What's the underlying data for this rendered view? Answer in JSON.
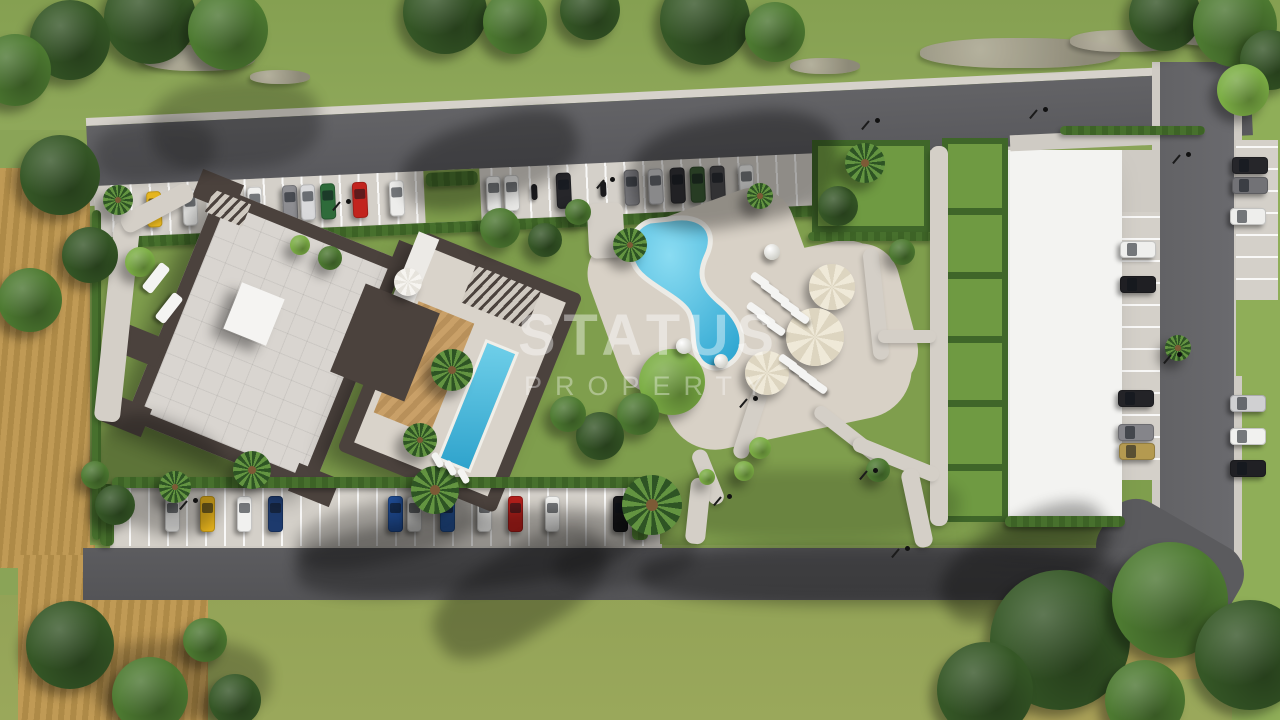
{
  "watermark": {
    "line1": "STATUS",
    "line2": "PROPERTY"
  },
  "palette": {
    "grassTop": "#8aa457",
    "grassBottom": "#9aa85b",
    "garden": "#7f9e4d",
    "field": "#bb9551",
    "road": "#5d5d60",
    "roadDark": "#55555a",
    "walk": "#d4cfc7",
    "apron": "#d4d0c9",
    "hedge": "#47702d",
    "wall": "#4b423d",
    "roof": "#d9d5d0",
    "deck": "#d8d1c6",
    "lawn": "#6f9a42",
    "wood": "#c49b63",
    "poolBlue": "#2ea6d1",
    "poolLight": "#8adcf2",
    "whiteRoof": "#f3f3f1",
    "umbrella": "#efe9d8"
  },
  "scene": {
    "shadows": [
      {
        "x": 400,
        "y": 120,
        "w": 180,
        "h": 80,
        "rot": -18,
        "op": 0.3
      },
      {
        "x": 630,
        "y": 115,
        "w": 210,
        "h": 110,
        "rot": -10,
        "op": 0.32
      },
      {
        "x": 150,
        "y": 80,
        "w": 170,
        "h": 90,
        "rot": -5,
        "op": 0.22
      },
      {
        "x": 95,
        "y": 120,
        "w": 120,
        "h": 60,
        "rot": -5,
        "op": 0.2
      },
      {
        "x": 88,
        "y": 420,
        "w": 140,
        "h": 110,
        "rot": 22,
        "op": 0.26
      },
      {
        "x": 295,
        "y": 515,
        "w": 340,
        "h": 75,
        "rot": -6,
        "op": 0.3
      },
      {
        "x": 425,
        "y": 550,
        "w": 190,
        "h": 85,
        "rot": -32,
        "op": 0.28
      },
      {
        "x": 935,
        "y": 520,
        "w": 180,
        "h": 85,
        "rot": -28,
        "op": 0.3
      },
      {
        "x": 295,
        "y": 502,
        "w": 180,
        "h": 60,
        "rot": -12,
        "op": 0.26
      },
      {
        "x": 555,
        "y": 535,
        "w": 140,
        "h": 50,
        "rot": -8,
        "op": 0.22
      },
      {
        "x": 640,
        "y": 545,
        "w": 480,
        "h": 60,
        "rot": 0,
        "op": 0.3
      },
      {
        "x": 660,
        "y": 470,
        "w": 300,
        "h": 70,
        "rot": 0,
        "op": 0.16
      },
      {
        "x": 90,
        "y": 640,
        "w": 180,
        "h": 80,
        "rot": 0,
        "op": 0.24
      }
    ],
    "rocks": [
      {
        "x": 920,
        "y": 38,
        "w": 200,
        "h": 30
      },
      {
        "x": 1070,
        "y": 30,
        "w": 110,
        "h": 22
      },
      {
        "x": 1168,
        "y": 22,
        "w": 95,
        "h": 24
      },
      {
        "x": 140,
        "y": 45,
        "w": 115,
        "h": 26
      },
      {
        "x": 790,
        "y": 58,
        "w": 70,
        "h": 16
      },
      {
        "x": 250,
        "y": 70,
        "w": 60,
        "h": 14
      }
    ],
    "hedges": [
      {
        "x": 112,
        "y": 477,
        "w": 548,
        "h": 11
      },
      {
        "x": 92,
        "y": 210,
        "w": 9,
        "h": 330
      },
      {
        "x": 1060,
        "y": 126,
        "w": 145,
        "h": 9
      },
      {
        "x": 1005,
        "y": 516,
        "w": 120,
        "h": 11
      },
      {
        "x": 632,
        "y": 478,
        "w": 16,
        "h": 62
      },
      {
        "x": 808,
        "y": 232,
        "w": 125,
        "h": 9
      }
    ],
    "paths": [
      {
        "x": 588,
        "y": 203,
        "w": 36,
        "h": 55,
        "rot": -3
      },
      {
        "x": 930,
        "y": 146,
        "w": 18,
        "h": 380,
        "rot": 0
      },
      {
        "x": 742,
        "y": 388,
        "w": 16,
        "h": 72,
        "rot": 18
      },
      {
        "x": 700,
        "y": 448,
        "w": 16,
        "h": 58,
        "rot": -22
      },
      {
        "x": 806,
        "y": 430,
        "w": 92,
        "h": 14,
        "rot": 38
      },
      {
        "x": 688,
        "y": 478,
        "w": 20,
        "h": 66,
        "rot": 6
      },
      {
        "x": 868,
        "y": 248,
        "w": 16,
        "h": 112,
        "rot": -6
      },
      {
        "x": 878,
        "y": 330,
        "w": 58,
        "h": 13,
        "rot": 0
      },
      {
        "x": 104,
        "y": 222,
        "w": 26,
        "h": 200,
        "rot": 6
      },
      {
        "x": 118,
        "y": 198,
        "w": 78,
        "h": 20,
        "rot": -28
      },
      {
        "x": 850,
        "y": 452,
        "w": 92,
        "h": 15,
        "rot": 22
      },
      {
        "x": 908,
        "y": 468,
        "w": 18,
        "h": 80,
        "rot": -12
      }
    ],
    "trees": [
      {
        "x": 150,
        "y": 18,
        "r": 46,
        "c": "#355726"
      },
      {
        "x": 228,
        "y": 30,
        "r": 40,
        "c": "#4d7a31"
      },
      {
        "x": 70,
        "y": 40,
        "r": 40,
        "c": "#355726"
      },
      {
        "x": 15,
        "y": 70,
        "r": 36,
        "c": "#4d7a31"
      },
      {
        "x": 445,
        "y": 12,
        "r": 42,
        "c": "#355726"
      },
      {
        "x": 515,
        "y": 22,
        "r": 32,
        "c": "#4d7a31"
      },
      {
        "x": 590,
        "y": 10,
        "r": 30,
        "c": "#355726"
      },
      {
        "x": 705,
        "y": 20,
        "r": 45,
        "c": "#355726"
      },
      {
        "x": 775,
        "y": 32,
        "r": 30,
        "c": "#4d7a31"
      },
      {
        "x": 1165,
        "y": 15,
        "r": 36,
        "c": "#355726"
      },
      {
        "x": 1235,
        "y": 25,
        "r": 42,
        "c": "#4d7a31"
      },
      {
        "x": 1270,
        "y": 60,
        "r": 30,
        "c": "#355726"
      },
      {
        "x": 1243,
        "y": 90,
        "r": 26,
        "c": "#7cae45"
      },
      {
        "x": 60,
        "y": 175,
        "r": 40,
        "c": "#355726"
      },
      {
        "x": 30,
        "y": 300,
        "r": 32,
        "c": "#4d7a31"
      },
      {
        "x": 90,
        "y": 255,
        "r": 28,
        "c": "#355726"
      },
      {
        "x": 70,
        "y": 645,
        "r": 44,
        "c": "#355726"
      },
      {
        "x": 150,
        "y": 695,
        "r": 38,
        "c": "#4d7a31"
      },
      {
        "x": 235,
        "y": 700,
        "r": 26,
        "c": "#355726"
      },
      {
        "x": 205,
        "y": 640,
        "r": 22,
        "c": "#4d7a31"
      },
      {
        "x": 140,
        "y": 262,
        "r": 15,
        "c": "#7cae45"
      },
      {
        "x": 500,
        "y": 228,
        "r": 20,
        "c": "#4d7a31"
      },
      {
        "x": 545,
        "y": 240,
        "r": 17,
        "c": "#355726"
      },
      {
        "x": 578,
        "y": 212,
        "r": 13,
        "c": "#4d7a31"
      },
      {
        "x": 672,
        "y": 382,
        "r": 33,
        "c": "#7cae45"
      },
      {
        "x": 638,
        "y": 414,
        "r": 21,
        "c": "#4d7a31"
      },
      {
        "x": 600,
        "y": 436,
        "r": 24,
        "c": "#355726"
      },
      {
        "x": 568,
        "y": 414,
        "r": 18,
        "c": "#4d7a31"
      },
      {
        "x": 760,
        "y": 448,
        "r": 11,
        "c": "#7cae45"
      },
      {
        "x": 744,
        "y": 471,
        "r": 10,
        "c": "#7cae45"
      },
      {
        "x": 707,
        "y": 477,
        "r": 8,
        "c": "#7cae45"
      },
      {
        "x": 838,
        "y": 206,
        "r": 20,
        "c": "#355726"
      },
      {
        "x": 902,
        "y": 252,
        "r": 13,
        "c": "#4d7a31"
      },
      {
        "x": 878,
        "y": 470,
        "r": 12,
        "c": "#4d7a31"
      },
      {
        "x": 115,
        "y": 505,
        "r": 20,
        "c": "#355726"
      },
      {
        "x": 95,
        "y": 475,
        "r": 14,
        "c": "#4d7a31"
      },
      {
        "x": 330,
        "y": 258,
        "r": 12,
        "c": "#4d7a31"
      },
      {
        "x": 300,
        "y": 245,
        "r": 10,
        "c": "#7cae45"
      },
      {
        "x": 1060,
        "y": 640,
        "r": 70,
        "c": "#355726"
      },
      {
        "x": 1170,
        "y": 600,
        "r": 58,
        "c": "#4d7a31"
      },
      {
        "x": 985,
        "y": 690,
        "r": 48,
        "c": "#355726"
      },
      {
        "x": 1250,
        "y": 655,
        "r": 55,
        "c": "#355726"
      },
      {
        "x": 1145,
        "y": 700,
        "r": 40,
        "c": "#4d7a31"
      }
    ],
    "palms": [
      {
        "x": 652,
        "y": 505,
        "r": 30
      },
      {
        "x": 435,
        "y": 490,
        "r": 24
      },
      {
        "x": 865,
        "y": 163,
        "r": 20
      },
      {
        "x": 1178,
        "y": 348,
        "r": 13
      },
      {
        "x": 630,
        "y": 245,
        "r": 17
      },
      {
        "x": 452,
        "y": 370,
        "r": 21
      },
      {
        "x": 420,
        "y": 440,
        "r": 17
      },
      {
        "x": 252,
        "y": 470,
        "r": 19
      },
      {
        "x": 118,
        "y": 200,
        "r": 15
      },
      {
        "x": 175,
        "y": 487,
        "r": 16
      },
      {
        "x": 760,
        "y": 196,
        "r": 13
      }
    ],
    "umbrellas": [
      {
        "x": 832,
        "y": 287,
        "r": 23,
        "c": "#efe9d8",
        "c2": "#ddd5c0"
      },
      {
        "x": 815,
        "y": 337,
        "r": 29,
        "c": "#efe9d8",
        "c2": "#ddd5c0"
      },
      {
        "x": 767,
        "y": 373,
        "r": 22,
        "c": "#efe9d8",
        "c2": "#ddd5c0"
      },
      {
        "x": 408,
        "y": 282,
        "r": 14,
        "c": "#f6f4f0",
        "c2": "#e6e3dc"
      }
    ],
    "balls": [
      {
        "x": 772,
        "y": 252,
        "r": 8
      },
      {
        "x": 684,
        "y": 346,
        "r": 8
      },
      {
        "x": 721,
        "y": 361,
        "r": 7
      }
    ],
    "loungers": [
      {
        "x": 756,
        "y": 270,
        "rot": -55,
        "w": 8,
        "h": 20
      },
      {
        "x": 766,
        "y": 279,
        "rot": -55,
        "w": 8,
        "h": 20
      },
      {
        "x": 776,
        "y": 288,
        "rot": -55,
        "w": 8,
        "h": 20
      },
      {
        "x": 786,
        "y": 297,
        "rot": -55,
        "w": 8,
        "h": 20
      },
      {
        "x": 796,
        "y": 306,
        "rot": -55,
        "w": 8,
        "h": 20
      },
      {
        "x": 752,
        "y": 300,
        "rot": -55,
        "w": 8,
        "h": 20
      },
      {
        "x": 762,
        "y": 309,
        "rot": -55,
        "w": 8,
        "h": 20
      },
      {
        "x": 772,
        "y": 318,
        "rot": -55,
        "w": 8,
        "h": 20
      },
      {
        "x": 784,
        "y": 352,
        "rot": -55,
        "w": 8,
        "h": 20
      },
      {
        "x": 794,
        "y": 360,
        "rot": -55,
        "w": 8,
        "h": 20
      },
      {
        "x": 804,
        "y": 368,
        "rot": -55,
        "w": 8,
        "h": 20
      },
      {
        "x": 814,
        "y": 376,
        "rot": -55,
        "w": 8,
        "h": 20
      },
      {
        "x": 150,
        "y": 262,
        "rot": 38,
        "w": 12,
        "h": 32
      },
      {
        "x": 163,
        "y": 292,
        "rot": 38,
        "w": 12,
        "h": 32
      },
      {
        "x": 434,
        "y": 452,
        "rot": -30,
        "w": 7,
        "h": 16
      },
      {
        "x": 447,
        "y": 460,
        "rot": -30,
        "w": 7,
        "h": 16
      },
      {
        "x": 460,
        "y": 468,
        "rot": -30,
        "w": 7,
        "h": 16
      }
    ],
    "lamps": [
      {
        "x": 610,
        "y": 177
      },
      {
        "x": 875,
        "y": 118
      },
      {
        "x": 1043,
        "y": 107
      },
      {
        "x": 346,
        "y": 199
      },
      {
        "x": 727,
        "y": 494
      },
      {
        "x": 753,
        "y": 396
      },
      {
        "x": 873,
        "y": 468
      },
      {
        "x": 1186,
        "y": 152
      },
      {
        "x": 1177,
        "y": 352
      },
      {
        "x": 905,
        "y": 546
      },
      {
        "x": 193,
        "y": 498
      }
    ],
    "top_cars": [
      {
        "x": 52,
        "c": "#e5b51f"
      },
      {
        "x": 88,
        "c": "#ebebe9"
      },
      {
        "x": 120,
        "c": "#232327"
      },
      {
        "x": 153,
        "c": "#f0f0ee"
      },
      {
        "x": 188,
        "c": "#8e8e92"
      },
      {
        "x": 206,
        "c": "#d9d9db"
      },
      {
        "x": 226,
        "c": "#2e6b3a"
      },
      {
        "x": 258,
        "c": "#c2241e"
      },
      {
        "x": 295,
        "c": "#ededeb"
      },
      {
        "x": 392,
        "c": "#f0f0ee"
      },
      {
        "x": 410,
        "c": "#e7e7e5"
      },
      {
        "x": 462,
        "c": "#26262a"
      },
      {
        "x": 530,
        "c": "#77777b"
      },
      {
        "x": 554,
        "c": "#cbcbcd"
      },
      {
        "x": 576,
        "c": "#323236"
      },
      {
        "x": 596,
        "c": "#3a5a34"
      },
      {
        "x": 616,
        "c": "#4a4a4e"
      },
      {
        "x": 645,
        "c": "#f2f2f0"
      }
    ],
    "motos": [
      {
        "x": 437
      },
      {
        "x": 506
      }
    ],
    "bottom_cars": [
      {
        "x": 53,
        "c": "#ededeb"
      },
      {
        "x": 88,
        "c": "#e8b51e"
      },
      {
        "x": 125,
        "c": "#f1f1ef"
      },
      {
        "x": 156,
        "c": "#1d3a6d"
      },
      {
        "x": 276,
        "c": "#2457a9"
      },
      {
        "x": 295,
        "c": "#efefed"
      },
      {
        "x": 328,
        "c": "#2d64b5"
      },
      {
        "x": 365,
        "c": "#f2f2f0"
      },
      {
        "x": 396,
        "c": "#b21f1b"
      },
      {
        "x": 433,
        "c": "#f3f3f1"
      },
      {
        "x": 501,
        "c": "#18181b"
      }
    ],
    "side_cars": [
      {
        "x": 1120,
        "y": 241,
        "c": "#efefed"
      },
      {
        "x": 1120,
        "y": 276,
        "c": "#1f1f23"
      },
      {
        "x": 1118,
        "y": 390,
        "c": "#232327"
      },
      {
        "x": 1118,
        "y": 424,
        "c": "#85858a"
      },
      {
        "x": 1119,
        "y": 443,
        "c": "#b49a50"
      },
      {
        "x": 1232,
        "y": 157,
        "c": "#26262a"
      },
      {
        "x": 1232,
        "y": 177,
        "c": "#727276"
      },
      {
        "x": 1230,
        "y": 208,
        "c": "#eeeeec"
      },
      {
        "x": 1230,
        "y": 395,
        "c": "#d0d0d2"
      },
      {
        "x": 1230,
        "y": 428,
        "c": "#f1f1ef"
      },
      {
        "x": 1230,
        "y": 460,
        "c": "#202024"
      }
    ]
  }
}
